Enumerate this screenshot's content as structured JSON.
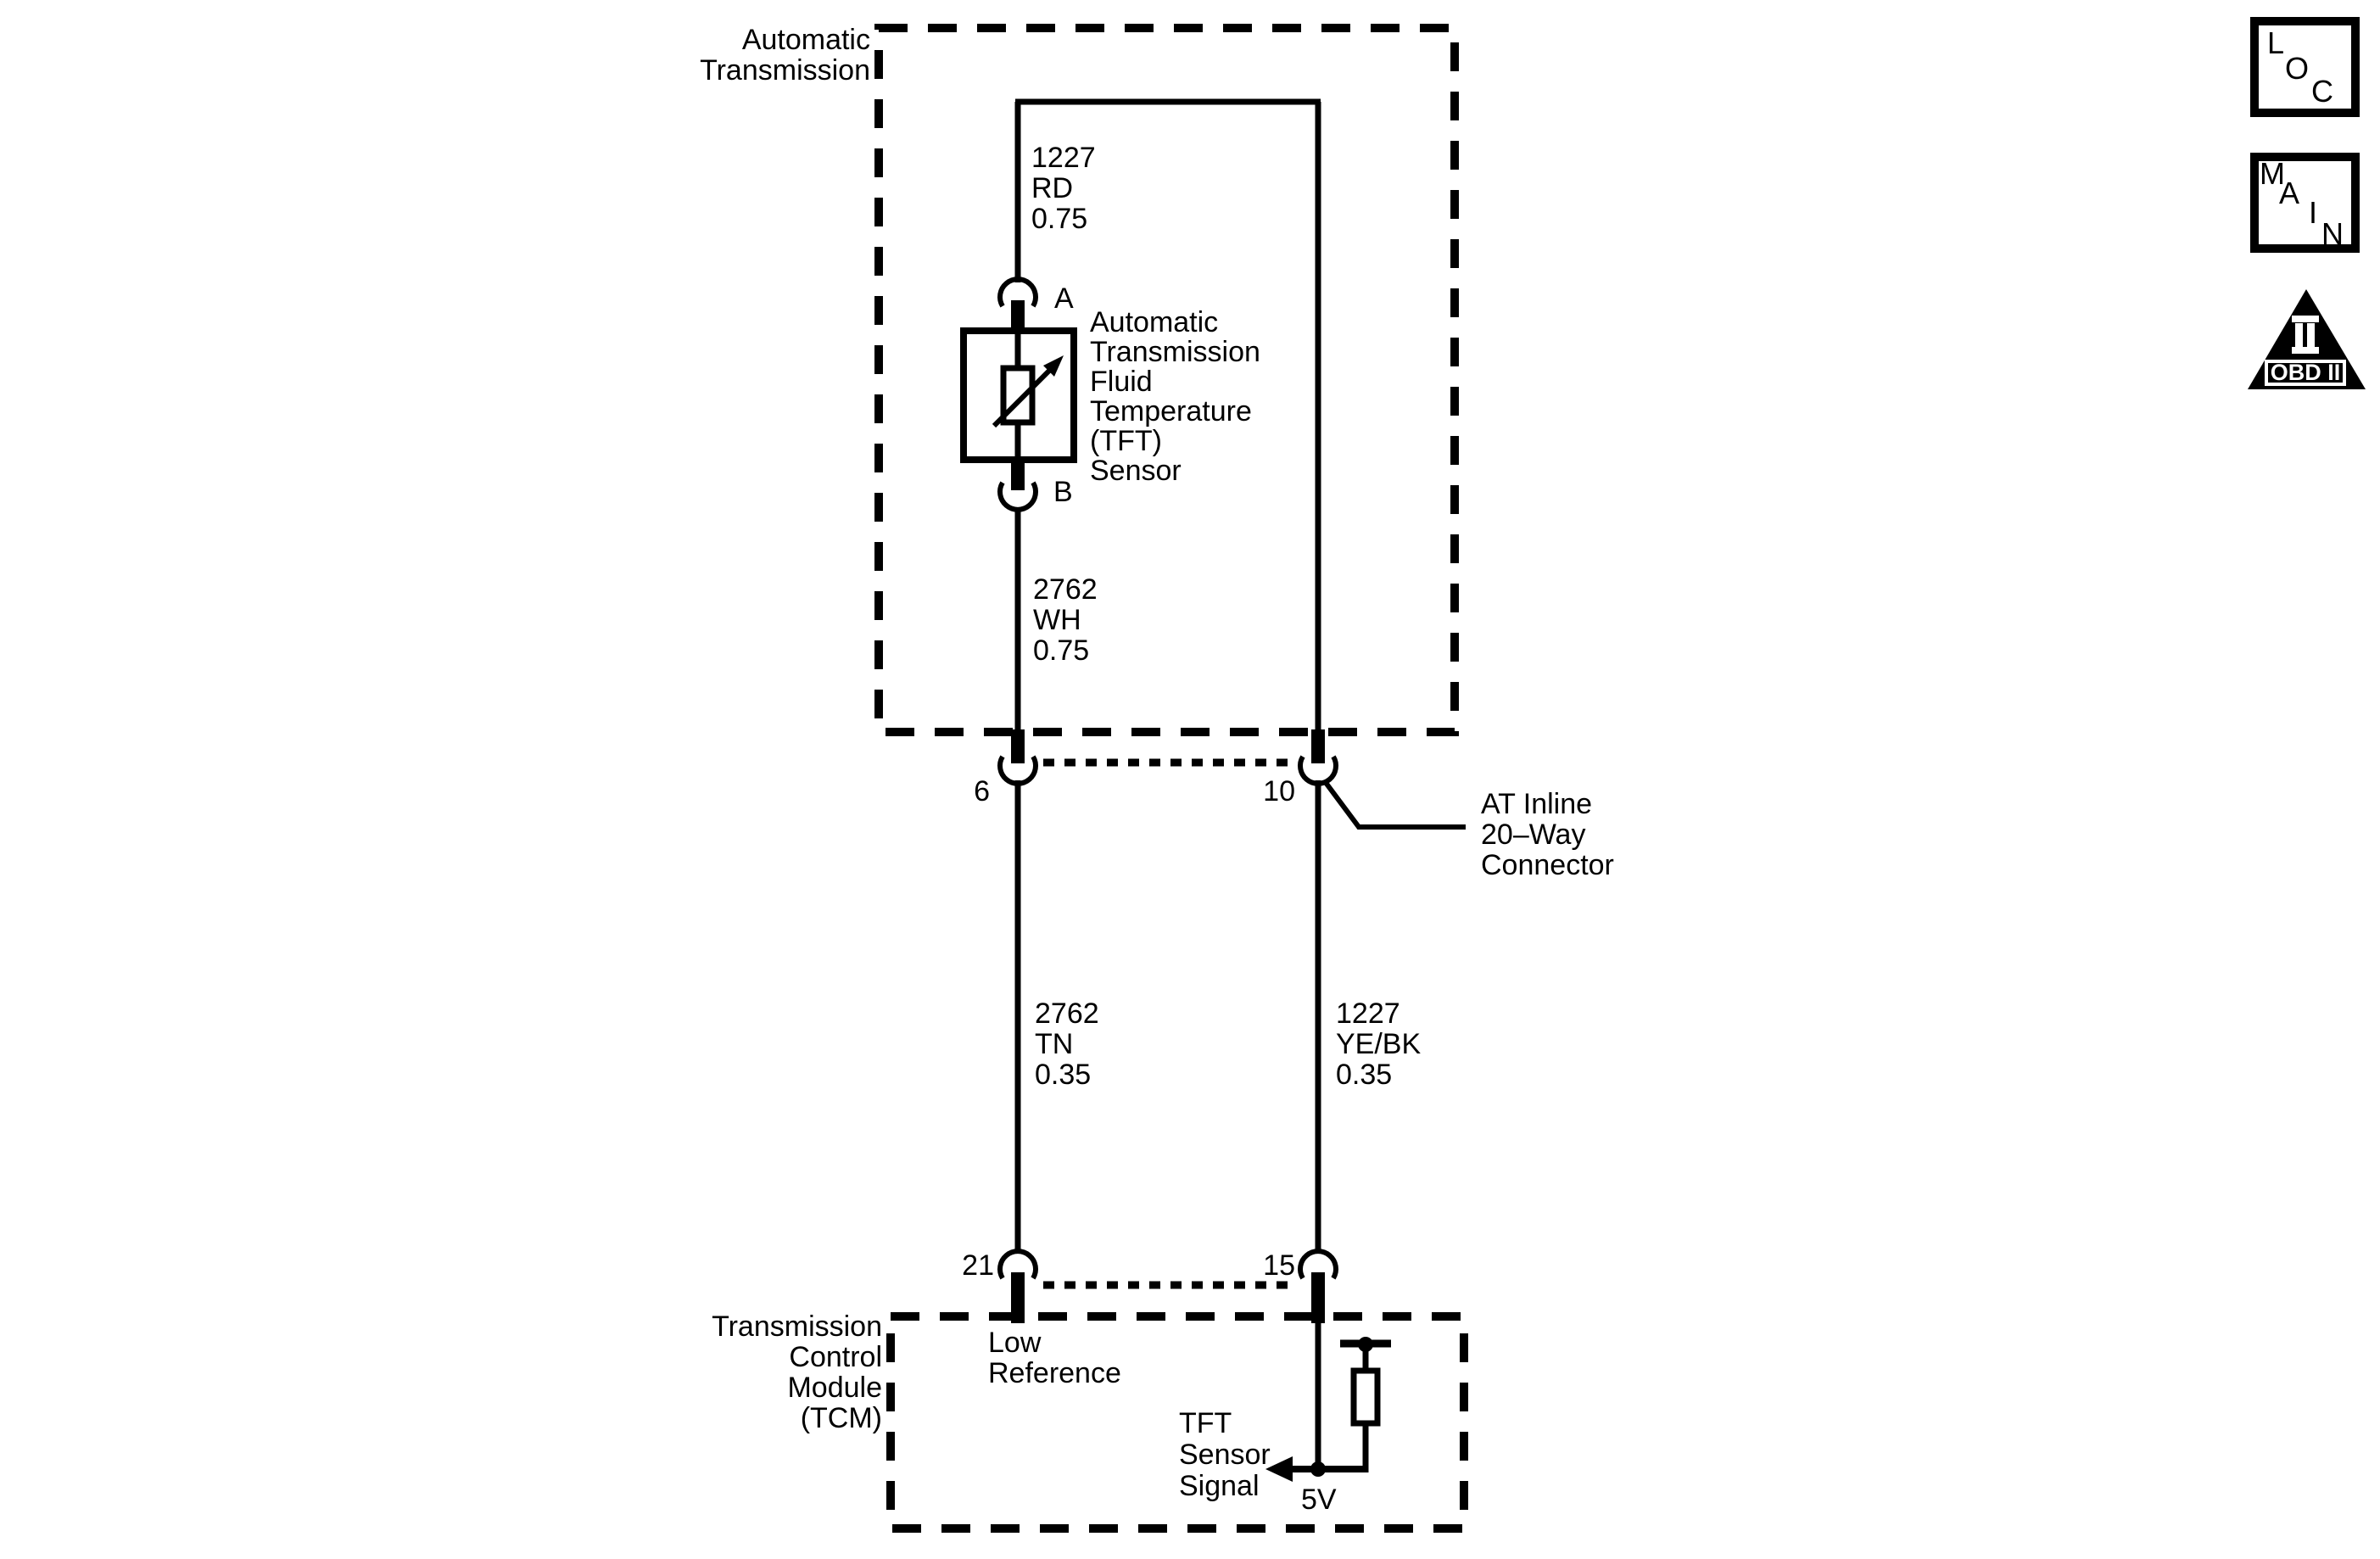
{
  "diagram": {
    "transmission_box": {
      "label_lines": [
        "Automatic",
        "Transmission"
      ]
    },
    "tft_sensor": {
      "terminal_a": "A",
      "terminal_b": "B",
      "label_lines": [
        "Automatic",
        "Transmission",
        "Fluid",
        "Temperature",
        "(TFT)",
        "Sensor"
      ]
    },
    "wires": {
      "sensor_signal_upper": {
        "lines": [
          "1227",
          "RD",
          "0.75"
        ]
      },
      "sensor_low_upper": {
        "lines": [
          "2762",
          "WH",
          "0.75"
        ]
      },
      "low_reference": {
        "lines": [
          "2762",
          "TN",
          "0.35"
        ]
      },
      "sensor_signal_lower": {
        "lines": [
          "1227",
          "YE/BK",
          "0.35"
        ]
      }
    },
    "inline_connector": {
      "pin_low": "6",
      "pin_signal": "10",
      "label_lines": [
        "AT Inline",
        "20–Way",
        "Connector"
      ]
    },
    "tcm": {
      "pin_low": "21",
      "pin_signal": "15",
      "label_lines": [
        "Transmission",
        "Control",
        "Module",
        "(TCM)"
      ],
      "low_reference_lines": [
        "Low",
        "Reference"
      ],
      "signal_lines": [
        "TFT",
        "Sensor",
        "Signal"
      ],
      "supply_label": "5V"
    }
  },
  "badges": {
    "loc_letters": [
      "L",
      "O",
      "C"
    ],
    "main_letters": [
      "M",
      "A",
      "I",
      "N"
    ],
    "obd_label": "OBD II"
  },
  "colors": {
    "ink": "#000000",
    "paper": "#ffffff"
  }
}
